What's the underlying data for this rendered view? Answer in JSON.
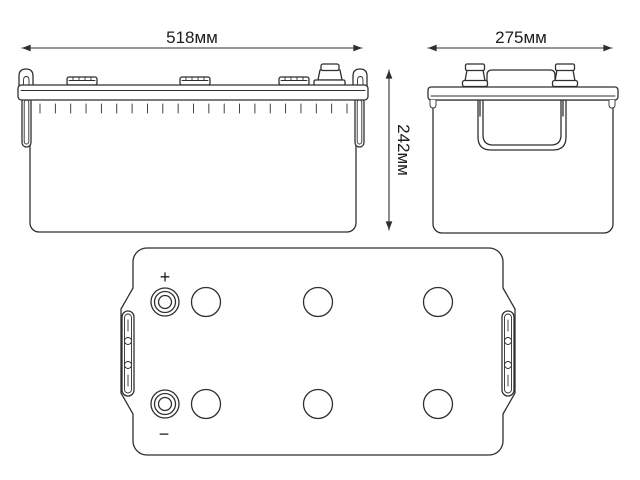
{
  "diagram": {
    "dimensions": {
      "width": "518мм",
      "depth": "275мм",
      "height": "242мм"
    },
    "terminals": {
      "positive": "+",
      "negative": "−"
    },
    "colors": {
      "line": "#2f2f2f",
      "text": "#1c1c1c",
      "background": "#ffffff"
    }
  }
}
